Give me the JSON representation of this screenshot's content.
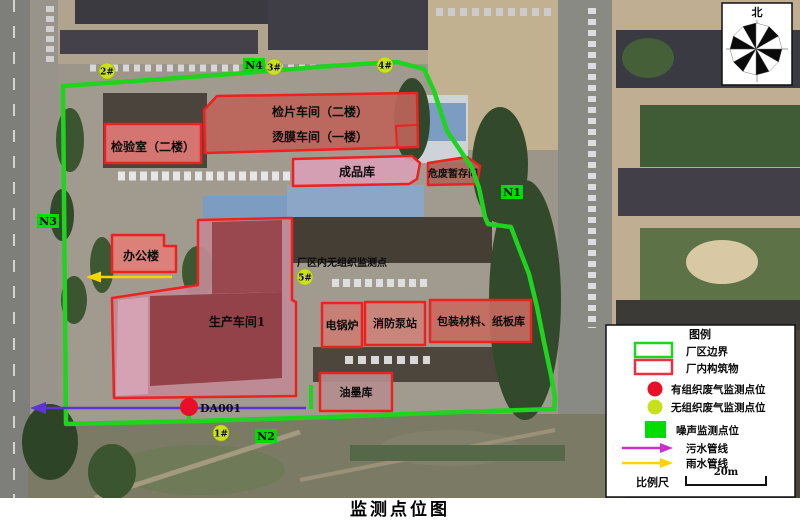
{
  "title": "监测点位图",
  "compass": {
    "north_label": "北"
  },
  "map": {
    "inplant_note": "厂区内无组织监测点",
    "buildings": [
      {
        "id": "inspection-room",
        "label": "检验室（二楼）"
      },
      {
        "id": "film-inspection-workshop",
        "label": "检片车间（二楼）"
      },
      {
        "id": "laminating-workshop",
        "label": "烫膜车间（一楼）"
      },
      {
        "id": "finished-goods-warehouse",
        "label": "成品库"
      },
      {
        "id": "hazardous-waste-storage",
        "label": "危废暂存间"
      },
      {
        "id": "office-building",
        "label": "办公楼"
      },
      {
        "id": "production-workshop-1",
        "label": "生产车间1"
      },
      {
        "id": "electric-boiler",
        "label": "电锅炉"
      },
      {
        "id": "fire-pump-station",
        "label": "消防泵站"
      },
      {
        "id": "packaging-materials-warehouse",
        "label": "包装材料、纸板库"
      },
      {
        "id": "ink-warehouse",
        "label": "油墨库"
      }
    ],
    "noise_points": [
      {
        "label": "N1"
      },
      {
        "label": "N2"
      },
      {
        "label": "N3"
      },
      {
        "label": "N4"
      }
    ],
    "fugitive_points": [
      {
        "label": "1#"
      },
      {
        "label": "2#"
      },
      {
        "label": "3#"
      },
      {
        "label": "4#"
      },
      {
        "label": "5#"
      }
    ],
    "stack_point": {
      "label": "DA001"
    }
  },
  "legend": {
    "title": "图例",
    "items": [
      {
        "symbol": "green-rectangle-outline",
        "label": "厂区边界"
      },
      {
        "symbol": "red-rectangle-outline",
        "label": "厂内构筑物"
      },
      {
        "symbol": "red-dot",
        "label": "有组织废气监测点位"
      },
      {
        "symbol": "yellow-green-dot",
        "label": "无组织废气监测点位"
      },
      {
        "symbol": "green-square",
        "label": "噪声监测点位"
      },
      {
        "symbol": "magenta-arrow",
        "label": "污水管线"
      },
      {
        "symbol": "yellow-arrow",
        "label": "雨水管线"
      }
    ],
    "scale_label": "比例尺",
    "scale_value": "20m"
  },
  "colors": {
    "boundary_green": "#1ed41e",
    "building_outline_red": "#ee2020",
    "organized_gas_red": "#ea0f28",
    "fugitive_gas_yellow_green": "#cbe01e",
    "noise_green": "#00dd00",
    "sewage_line_map": "#5b33d6",
    "sewage_line_legend": "#cc2fcc",
    "rain_line_yellow": "#ffd400"
  }
}
